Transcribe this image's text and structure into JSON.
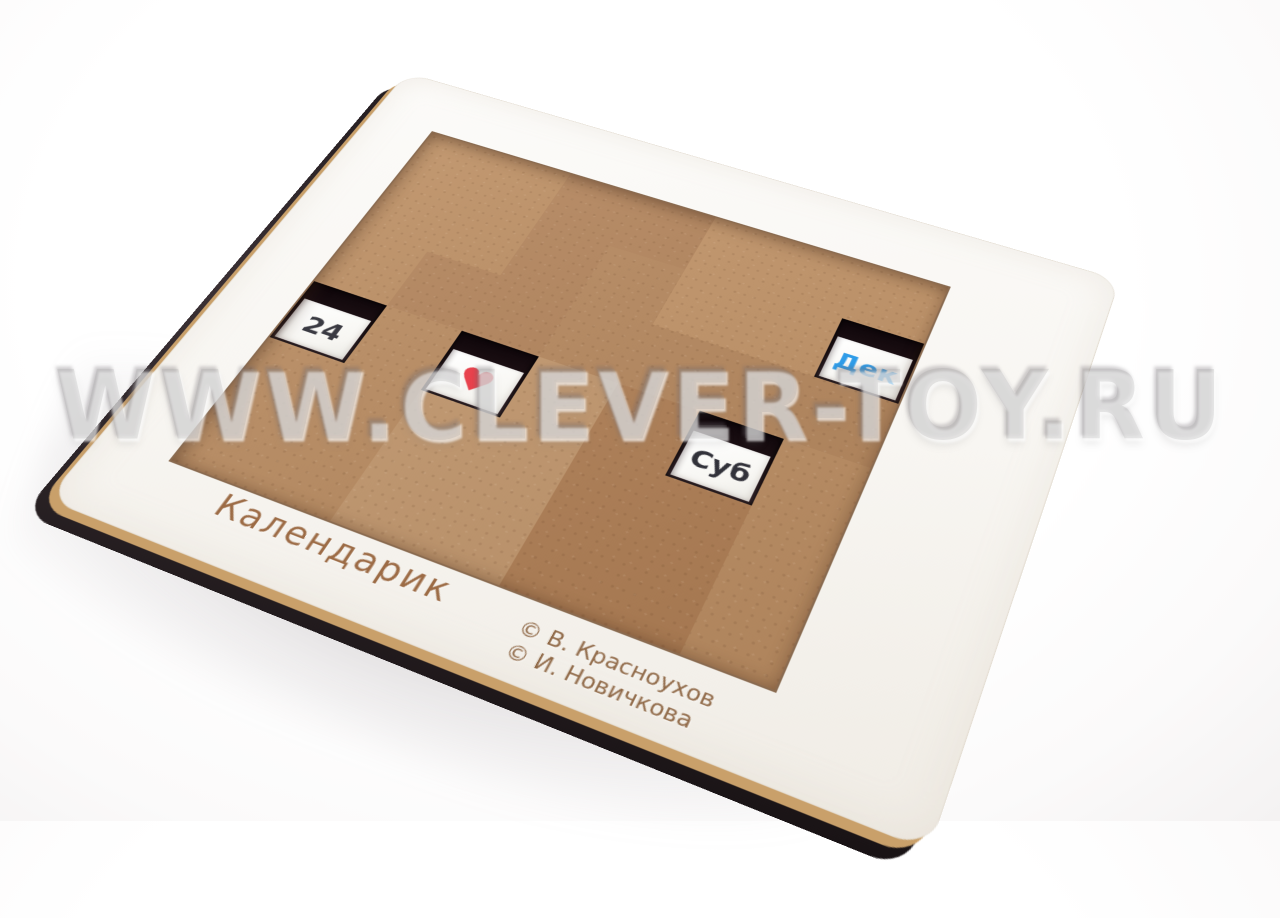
{
  "board": {
    "title": "Календарик",
    "credits": [
      "© В. Красноухов",
      "© И. Новичкова"
    ]
  },
  "watermark": {
    "text": "WWW.CLEVER-TOY.RU"
  },
  "windows": {
    "date": {
      "value": "24"
    },
    "heart": {
      "symbol": "♥"
    },
    "weekday": {
      "value": "Суб"
    },
    "month": {
      "value": "Дек"
    }
  },
  "colors": {
    "board_top": "#f8f6f2",
    "board_side": "#332a2e",
    "glue_line": "#c9a06a",
    "piece_wood": "#b8895c",
    "tray_base": "#2e2327",
    "date_text": "#3a3a42",
    "weekday_text": "#32323a",
    "month_text": "#2f9ce8",
    "heart_red": "#e8424d",
    "engraving_brown": "#9c6b45"
  }
}
